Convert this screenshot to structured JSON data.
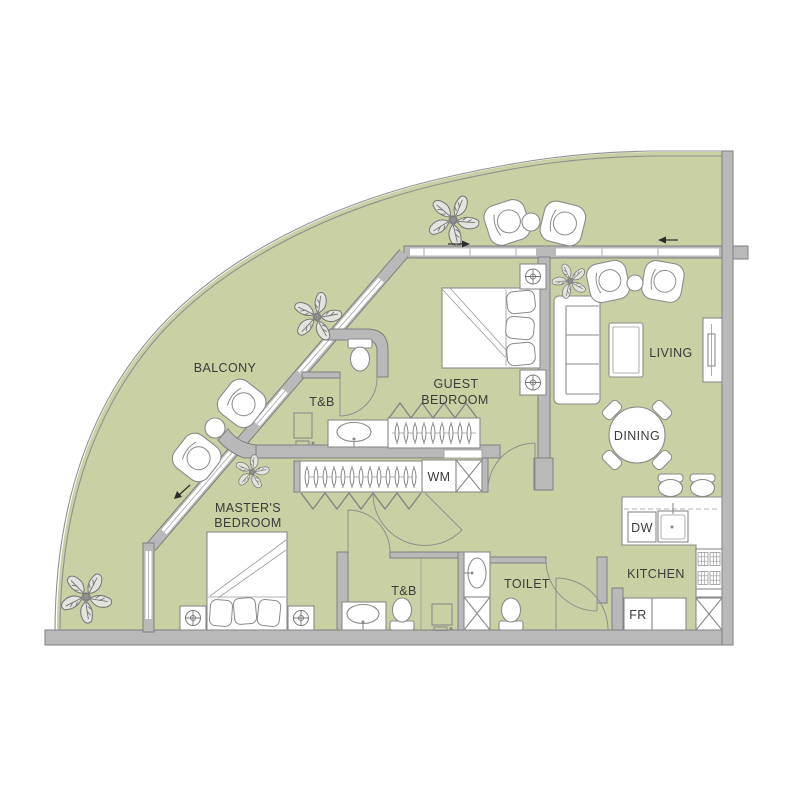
{
  "colors": {
    "floor": "#c9d0a4",
    "wall": "#b9b9b9",
    "wall_stroke": "#7e7e7e",
    "furniture_stroke": "#8a8a8a",
    "text": "#3b3b3b",
    "plant": "#777777"
  },
  "rooms": {
    "balcony": "BALCONY",
    "master_bedroom": [
      "MASTER'S",
      "BEDROOM"
    ],
    "guest_bedroom": [
      "GUEST",
      "BEDROOM"
    ],
    "guest_bath": "T&B",
    "master_bath": "T&B",
    "toilet": "TOILET",
    "living": "LIVING",
    "dining": "DINING",
    "kitchen": "KITCHEN"
  },
  "appliances": {
    "washing_machine": "WM",
    "dishwasher": "DW",
    "refrigerator": "FR"
  }
}
